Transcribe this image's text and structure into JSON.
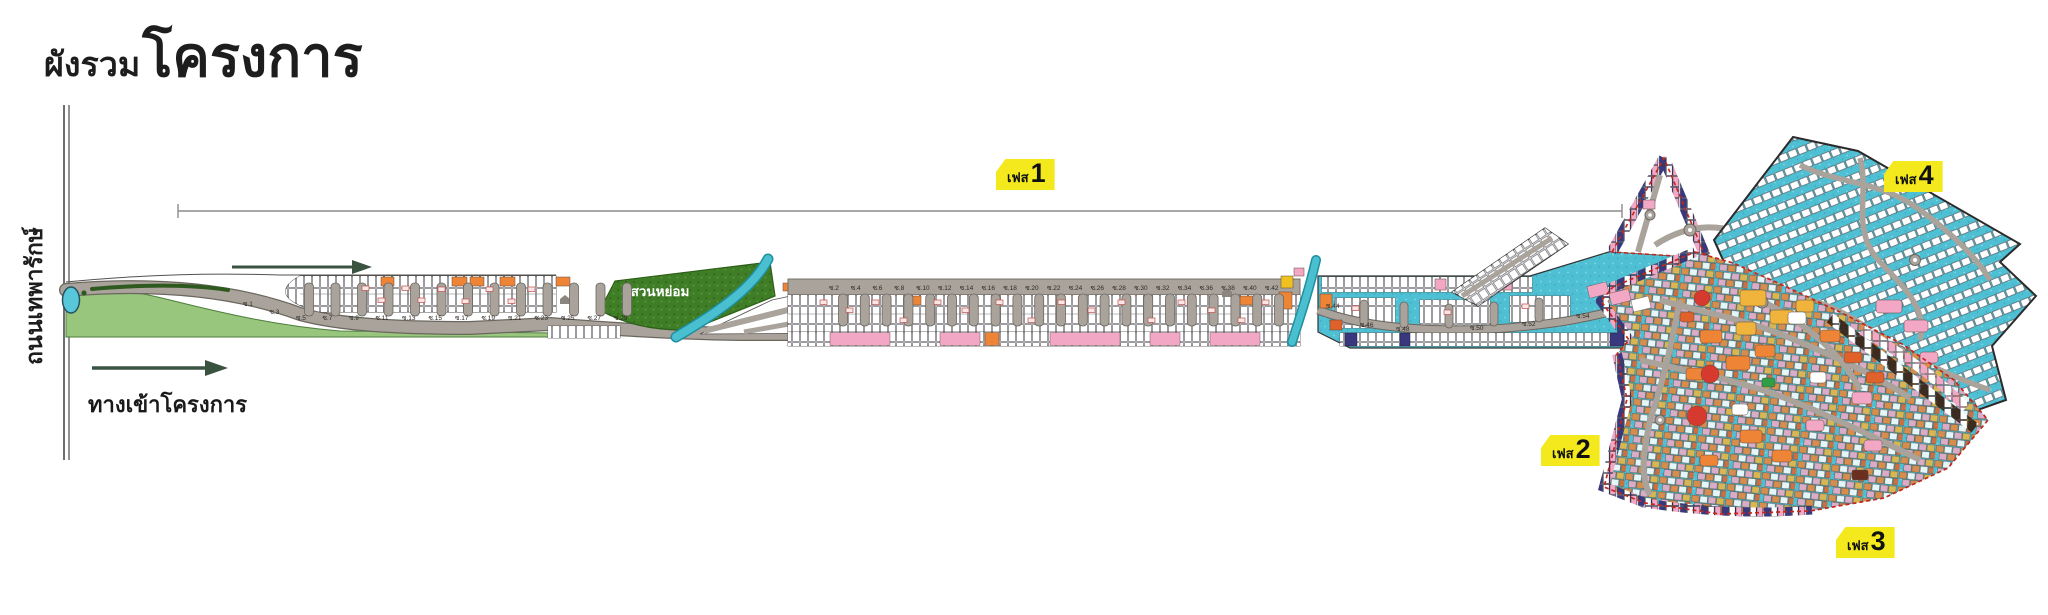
{
  "title": {
    "prefix": "ผังรวม",
    "main": "โครงการ"
  },
  "left_road": {
    "label": "ถนนเทพารักษ์"
  },
  "entrance": {
    "label": "ทางเข้าโครงการ"
  },
  "garden": {
    "label": "สวนหย่อม"
  },
  "phases": [
    {
      "prefix": "เฟส",
      "number": "1"
    },
    {
      "prefix": "เฟส",
      "number": "2"
    },
    {
      "prefix": "เฟส",
      "number": "3"
    },
    {
      "prefix": "เฟส",
      "number": "4"
    }
  ],
  "sois": {
    "south_row": [
      "ซ.1",
      "ซ.3",
      "ซ.5",
      "ซ.7",
      "ซ.9",
      "ซ.11",
      "ซ.13",
      "ซ.15",
      "ซ.17",
      "ซ.19",
      "ซ.21",
      "ซ.23",
      "ซ.25",
      "ซ.27",
      "ซ.29"
    ],
    "north_row": [
      "ซ.2",
      "ซ.4",
      "ซ.6",
      "ซ.8",
      "ซ.10",
      "ซ.12",
      "ซ.14",
      "ซ.16",
      "ซ.18",
      "ซ.20",
      "ซ.22",
      "ซ.24",
      "ซ.26",
      "ซ.28",
      "ซ.30",
      "ซ.32",
      "ซ.34",
      "ซ.36",
      "ซ.38",
      "ซ.40",
      "ซ.42"
    ],
    "curve_row": [
      "ซ.44",
      "ซ.46",
      "ซ.48",
      "ซ.50",
      "ซ.52",
      "ซ.54"
    ]
  },
  "colors": {
    "phase_label_bg": "#f3e91c",
    "teal_water": "#49bfcf",
    "teal_zone": "#4fc0d3",
    "lawn_green": "#97c67c",
    "garden_green": "#3f7d27",
    "road_grey": "#a9a39b",
    "plot_pink": "#f2a8c4",
    "plot_orange": "#ee8435",
    "plot_yellow": "#f0b43c",
    "plot_red": "#d63a2f",
    "plot_navy": "#39387e",
    "boundary_red": "#c2271f"
  }
}
